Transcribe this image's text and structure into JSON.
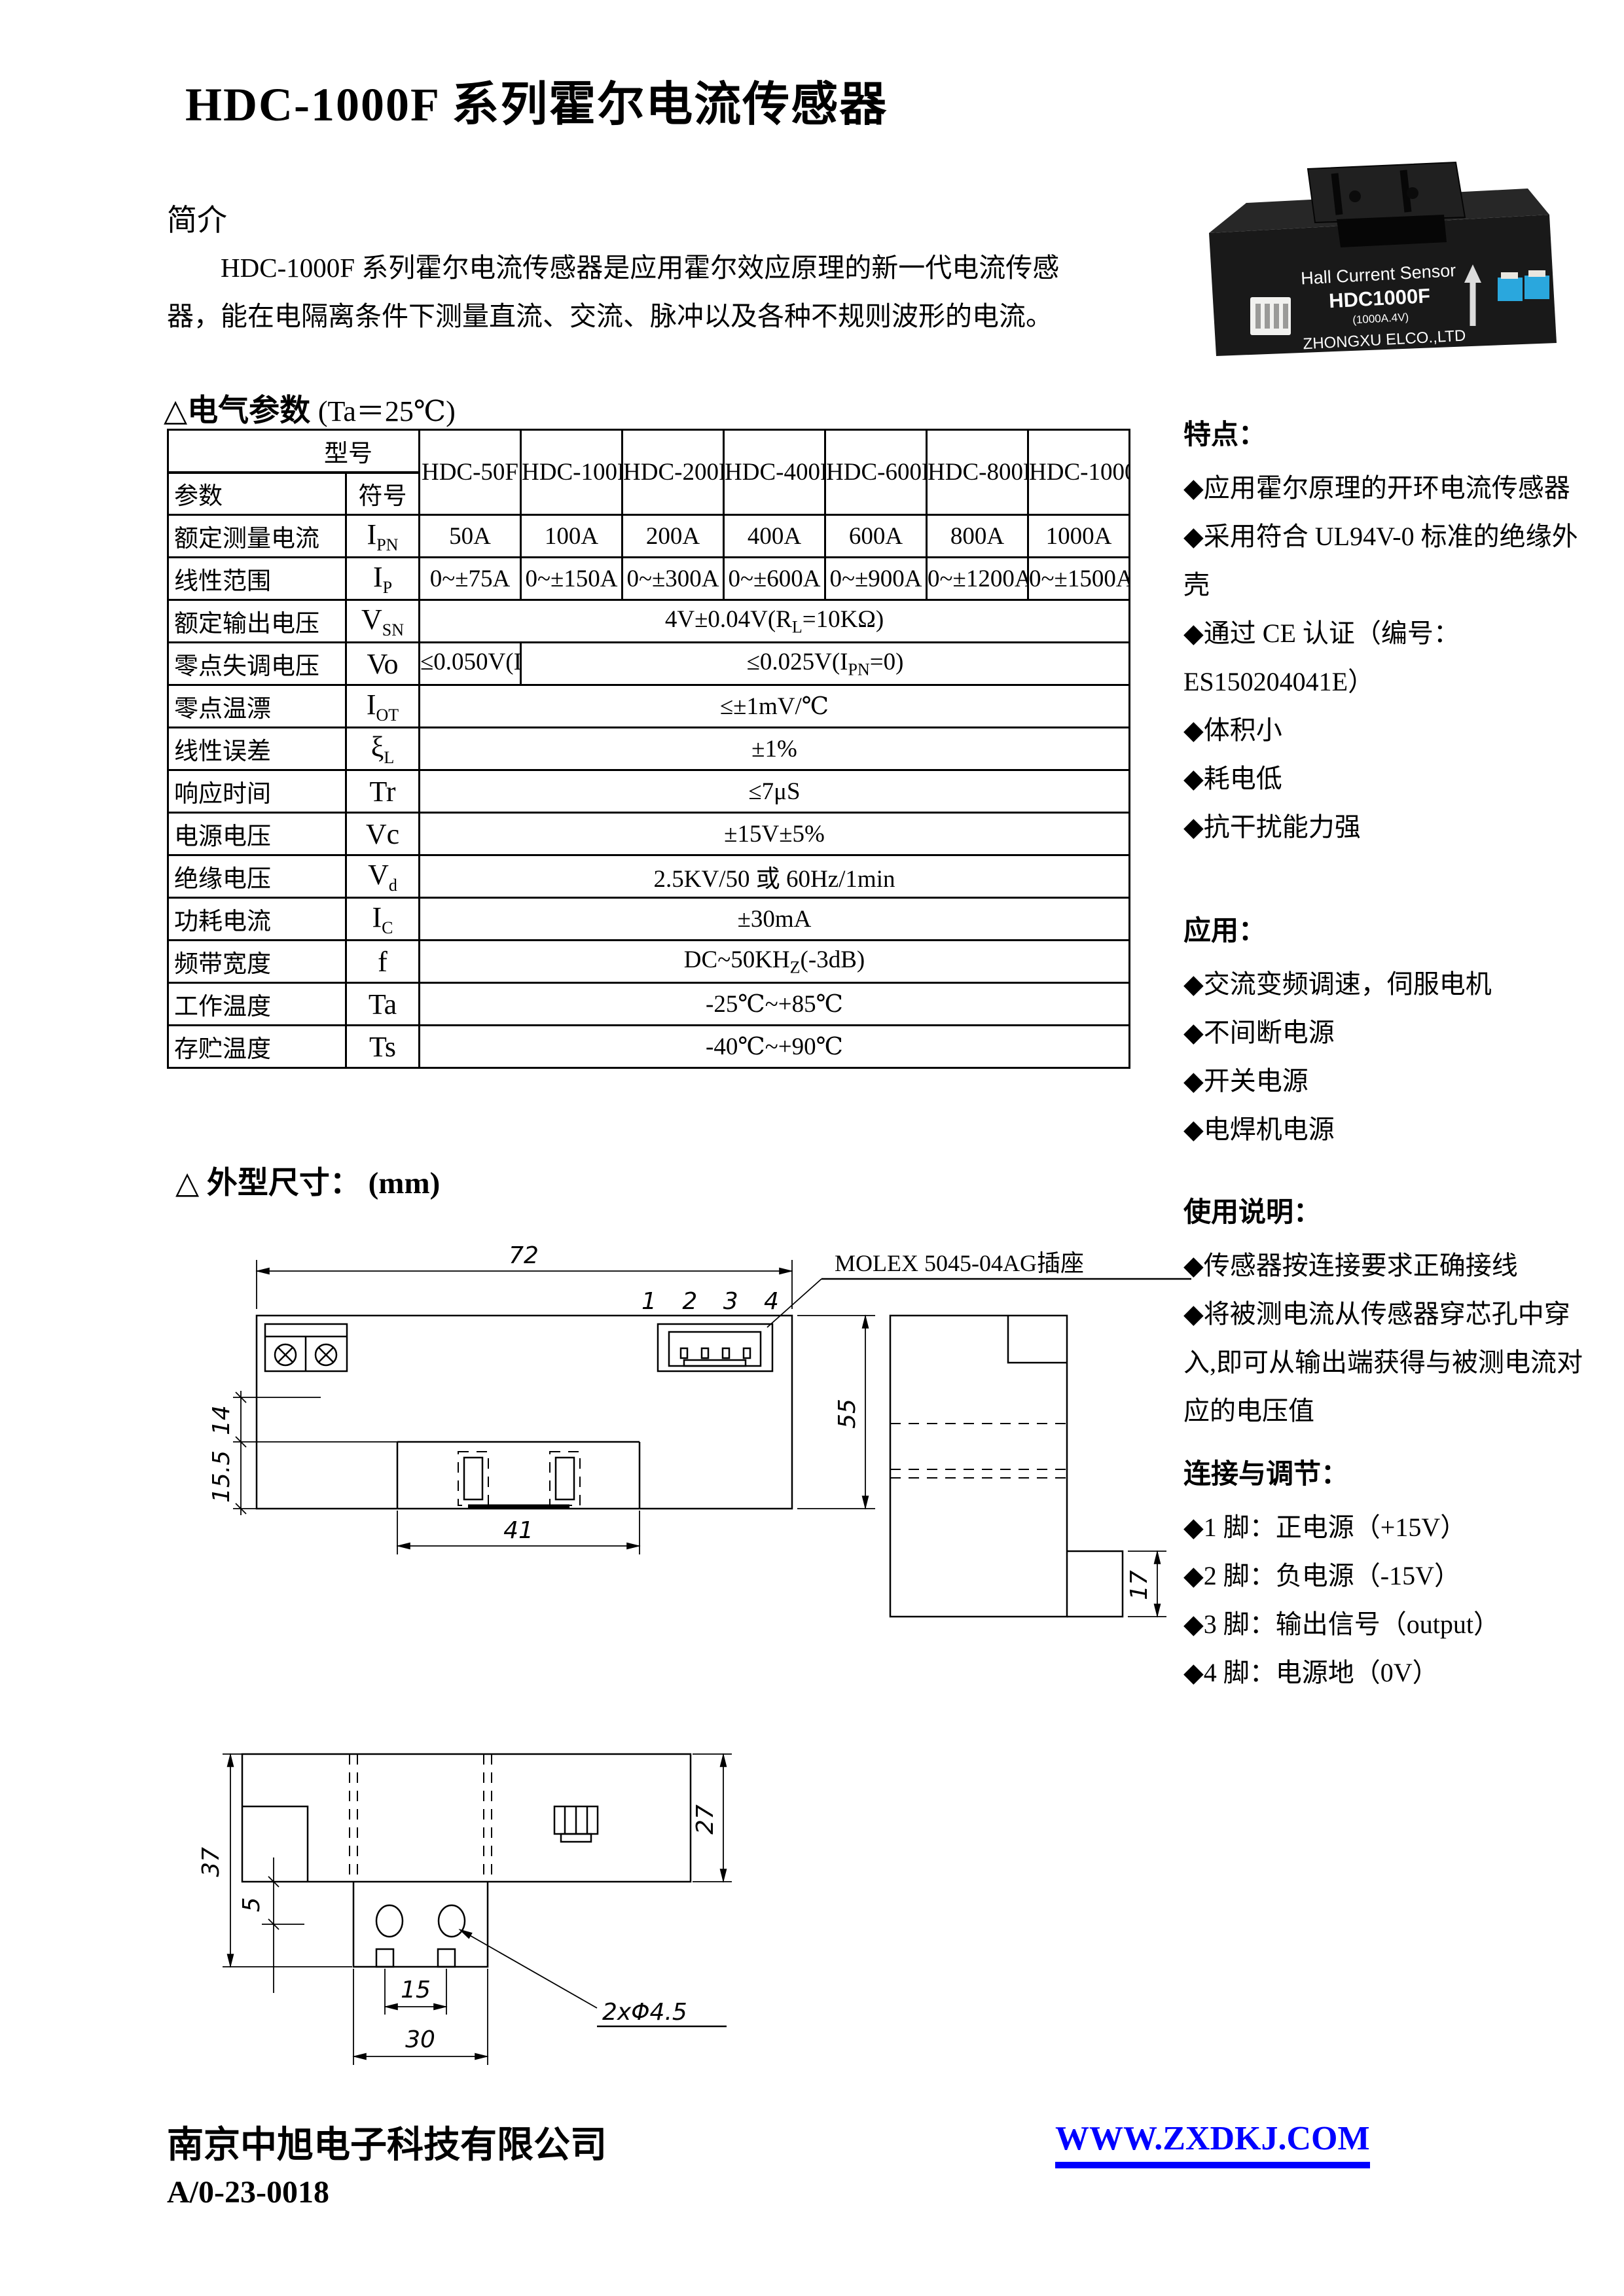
{
  "header": {
    "title": "HDC-1000F 系列霍尔电流传感器"
  },
  "intro": {
    "heading": "简介",
    "text": "HDC-1000F 系列霍尔电流传感器是应用霍尔效应原理的新一代电流传感器，能在电隔离条件下测量直流、交流、脉冲以及各种不规则波形的电流。"
  },
  "photo": {
    "line1": "Hall Current Sensor",
    "line2": "HDC1000F",
    "line3": "(1000A.4V)",
    "line4": "ZHONGXU ELCO.,LTD"
  },
  "electrical": {
    "heading": "△电气参数",
    "heading_cond": "(Ta＝25℃)",
    "corner": {
      "model": "型号",
      "param": "参数",
      "symbol": "符号"
    },
    "models": [
      "HDC-50F",
      "HDC-100F",
      "HDC-200F",
      "HDC-400F",
      "HDC-600F",
      "HDC-800F",
      "HDC-1000F"
    ],
    "rows": [
      {
        "param": "额定测量电流",
        "symbol_html": "I<sub>PN</sub>",
        "values": [
          "50A",
          "100A",
          "200A",
          "400A",
          "600A",
          "800A",
          "1000A"
        ]
      },
      {
        "param": "线性范围",
        "symbol_html": "I<sub>P</sub>",
        "values": [
          "0~±75A",
          "0~±150A",
          "0~±300A",
          "0~±600A",
          "0~±900A",
          "0~±1200A",
          "0~±1500A"
        ]
      },
      {
        "param": "额定输出电压",
        "symbol_html": "V<sub>SN</sub>",
        "span_html": "4V±0.04V(R<sub>L</sub>=10KΩ)"
      },
      {
        "param": "零点失调电压",
        "symbol_html": "Vo",
        "first_html": "≤0.050V(I<sub>PN</sub>=0)",
        "rest_html": "≤0.025V(I<sub>PN</sub>=0)"
      },
      {
        "param": "零点温漂",
        "symbol_html": "I<sub>OT</sub>",
        "span_html": "≤±1mV/℃"
      },
      {
        "param": "线性误差",
        "symbol_html": "ξ<sub>L</sub>",
        "span_html": "±1%"
      },
      {
        "param": "响应时间",
        "symbol_html": "Tr",
        "span_html": "≤7μS"
      },
      {
        "param": "电源电压",
        "symbol_html": "Vc",
        "span_html": "±15V±5%"
      },
      {
        "param": "绝缘电压",
        "symbol_html": "V<sub>d</sub>",
        "span_html": "2.5KV/50 或 60Hz/1min"
      },
      {
        "param": "功耗电流",
        "symbol_html": "I<sub>C</sub>",
        "span_html": "±30mA"
      },
      {
        "param": "频带宽度",
        "symbol_html": "f",
        "span_html": "DC~50KH<sub>Z</sub>(-3dB)"
      },
      {
        "param": "工作温度",
        "symbol_html": "Ta",
        "span_html": "-25℃~+85℃"
      },
      {
        "param": "存贮温度",
        "symbol_html": "Ts",
        "span_html": "-40℃~+90℃"
      }
    ]
  },
  "dimensions_section": {
    "heading": "△ 外型尺寸：",
    "unit": "(mm)"
  },
  "drawing": {
    "top_view": {
      "dim_width": "72",
      "dim_height": "55",
      "dim_window": "41",
      "dim_upper": "14",
      "dim_lower": "15.5",
      "dim_side": "17",
      "pin_numbers": "1 2 3 4",
      "connector_label": "MOLEX 5045-04AG插座"
    },
    "bottom_view": {
      "dim_height": "37",
      "dim_right": "27",
      "dim_offset": "5",
      "dim_holes": "15",
      "dim_tab": "30",
      "holes_label": "2xΦ4.5"
    }
  },
  "sidebar": {
    "features": {
      "heading": "特点：",
      "items": [
        "◆应用霍尔原理的开环电流传感器",
        "◆采用符合 UL94V-0 标准的绝缘外壳",
        "◆通过 CE 认证（编号：ES150204041E）",
        "◆体积小",
        "◆耗电低",
        "◆抗干扰能力强"
      ]
    },
    "applications": {
      "heading": "应用：",
      "items": [
        "◆交流变频调速，伺服电机",
        "◆不间断电源",
        "◆开关电源",
        "◆电焊机电源"
      ]
    },
    "usage": {
      "heading": "使用说明：",
      "items": [
        "◆传感器按连接要求正确接线",
        "◆将被测电流从传感器穿芯孔中穿入,即可从输出端获得与被测电流对应的电压值"
      ]
    },
    "connection": {
      "heading": "连接与调节：",
      "items": [
        "◆1 脚：正电源（+15V）",
        "◆2 脚：负电源（-15V）",
        "◆3 脚：输出信号（output）",
        "◆4 脚：电源地（0V）"
      ]
    }
  },
  "footer": {
    "company": "南京中旭电子科技有限公司",
    "doc_number": "A/0-23-0018",
    "website": "WWW.ZXDKJ.COM",
    "website_color": "#0000ff"
  }
}
